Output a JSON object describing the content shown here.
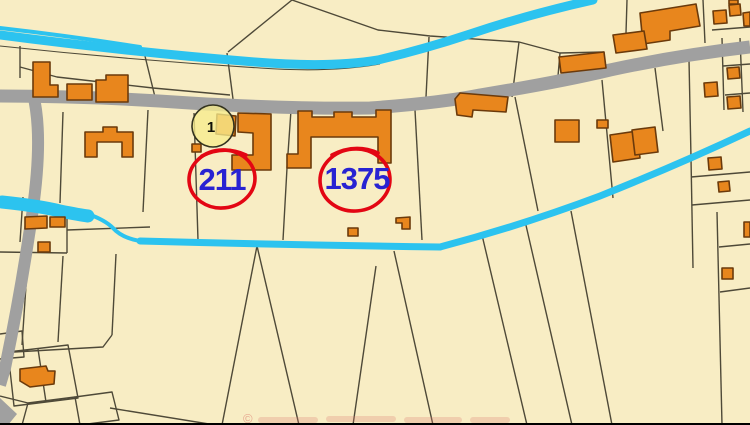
{
  "map": {
    "marker": {
      "label": "1"
    },
    "parcel_annotations": [
      {
        "id": "parcel-211",
        "label": "211"
      },
      {
        "id": "parcel-1375",
        "label": "1375"
      }
    ],
    "watermark": {
      "symbol": "©"
    }
  },
  "colors": {
    "background": "#F8EDC4",
    "parcel_line": "#4E4938",
    "road": "#A0A0A0",
    "water": "#2CC3EF",
    "building": "#E8861D",
    "building_outline": "#6B3A0B",
    "marker_fill": "#F6EC8D",
    "marker_stroke": "#33331F",
    "annotation_red": "#E30613",
    "annotation_blue": "#2823D2",
    "watermark_red": "#DC7A6E",
    "bottom_bar": "#000000"
  }
}
